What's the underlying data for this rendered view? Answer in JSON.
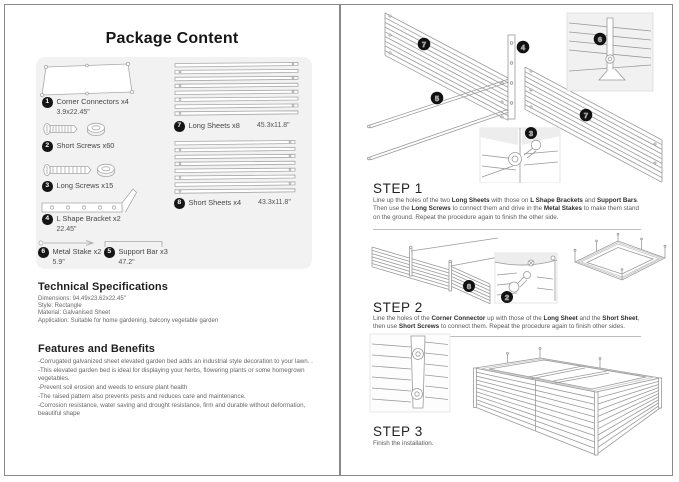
{
  "title": "Package Content",
  "package": {
    "items": [
      {
        "num": "1",
        "label": "Corner Connectors x4",
        "dim": "3.9x22.45\""
      },
      {
        "num": "2",
        "label": "Short Screws x60",
        "dim": ""
      },
      {
        "num": "3",
        "label": "Long Screws x15",
        "dim": ""
      },
      {
        "num": "4",
        "label": "L Shape Bracket x2",
        "dim": "22.45\""
      },
      {
        "num": "6",
        "label": "Metal Stake x2",
        "dim": "5.9\""
      },
      {
        "num": "5",
        "label": "Support Bar x3",
        "dim": "47.2\""
      },
      {
        "num": "7",
        "label": "Long Sheets x8",
        "dim": "45.3x11.8\""
      },
      {
        "num": "8",
        "label": "Short Sheets x4",
        "dim": "43.3x11.8\""
      }
    ]
  },
  "tech": {
    "title": "Technical Specifications",
    "lines": [
      "Dimensions: 94.49x23.62x22.45\"",
      "Style: Rectangle",
      "Material: Galvanised Sheet",
      "Application: Suitable for home gardening, balcony vegetable garden"
    ]
  },
  "features": {
    "title": "Features and Benefits",
    "bullets": [
      "-Corrugated galvanized sheet elevated garden bed adds an industrial style decoration to your lawn. .",
      "-This elevated garden bed is ideal for displaying your herbs, flowering plants or some homegrown vegetables.",
      "-Prevent soil erosion and weeds to ensure plant health",
      "-The raised pattern also prevents pests and reduces care and maintenance.",
      "-Corrosion resistance, water saving and drought resistance, firm and durable without deformation, beautiful shape"
    ]
  },
  "steps": {
    "step1": {
      "title": "STEP 1",
      "labels": {
        "sheet_left": "7",
        "bracket": "4",
        "stake_inset": "6",
        "support": "5",
        "sheet_right": "7",
        "screw_inset": "3"
      },
      "segments": [
        {
          "t": "Line up the holes of the two "
        },
        {
          "t": "Long Sheets"
        },
        {
          "t": " with those on "
        },
        {
          "t": "L Shape Brackets"
        },
        {
          "t": " and "
        },
        {
          "t": "Support Bars"
        },
        {
          "t": ". Then use the "
        },
        {
          "t": "Long Screws"
        },
        {
          "t": " to connect them and drive in the "
        },
        {
          "t": "Metal Stakes"
        },
        {
          "t": " to make them stand on the ground. Repeat the procedure again to finish the other side."
        }
      ]
    },
    "step2": {
      "title": "STEP 2",
      "labels": {
        "short_sheet": "8",
        "screw_inset": "2"
      },
      "segments": [
        {
          "t": "Line the holes of the "
        },
        {
          "t": "Corner Connector"
        },
        {
          "t": " up with those of the "
        },
        {
          "t": "Long Sheet"
        },
        {
          "t": " and the "
        },
        {
          "t": "Short Sheet"
        },
        {
          "t": ", then use "
        },
        {
          "t": "Short Screws"
        },
        {
          "t": " to connect them. Repeat the procedure again to finish other sides."
        }
      ]
    },
    "step3": {
      "title": "STEP 3",
      "segments": [
        {
          "t": "Finish the installation."
        }
      ]
    }
  },
  "colors": {
    "accent_circle": "#151515",
    "panel_bg": "#f2f2f2",
    "line_art": "#9a9a9a"
  }
}
